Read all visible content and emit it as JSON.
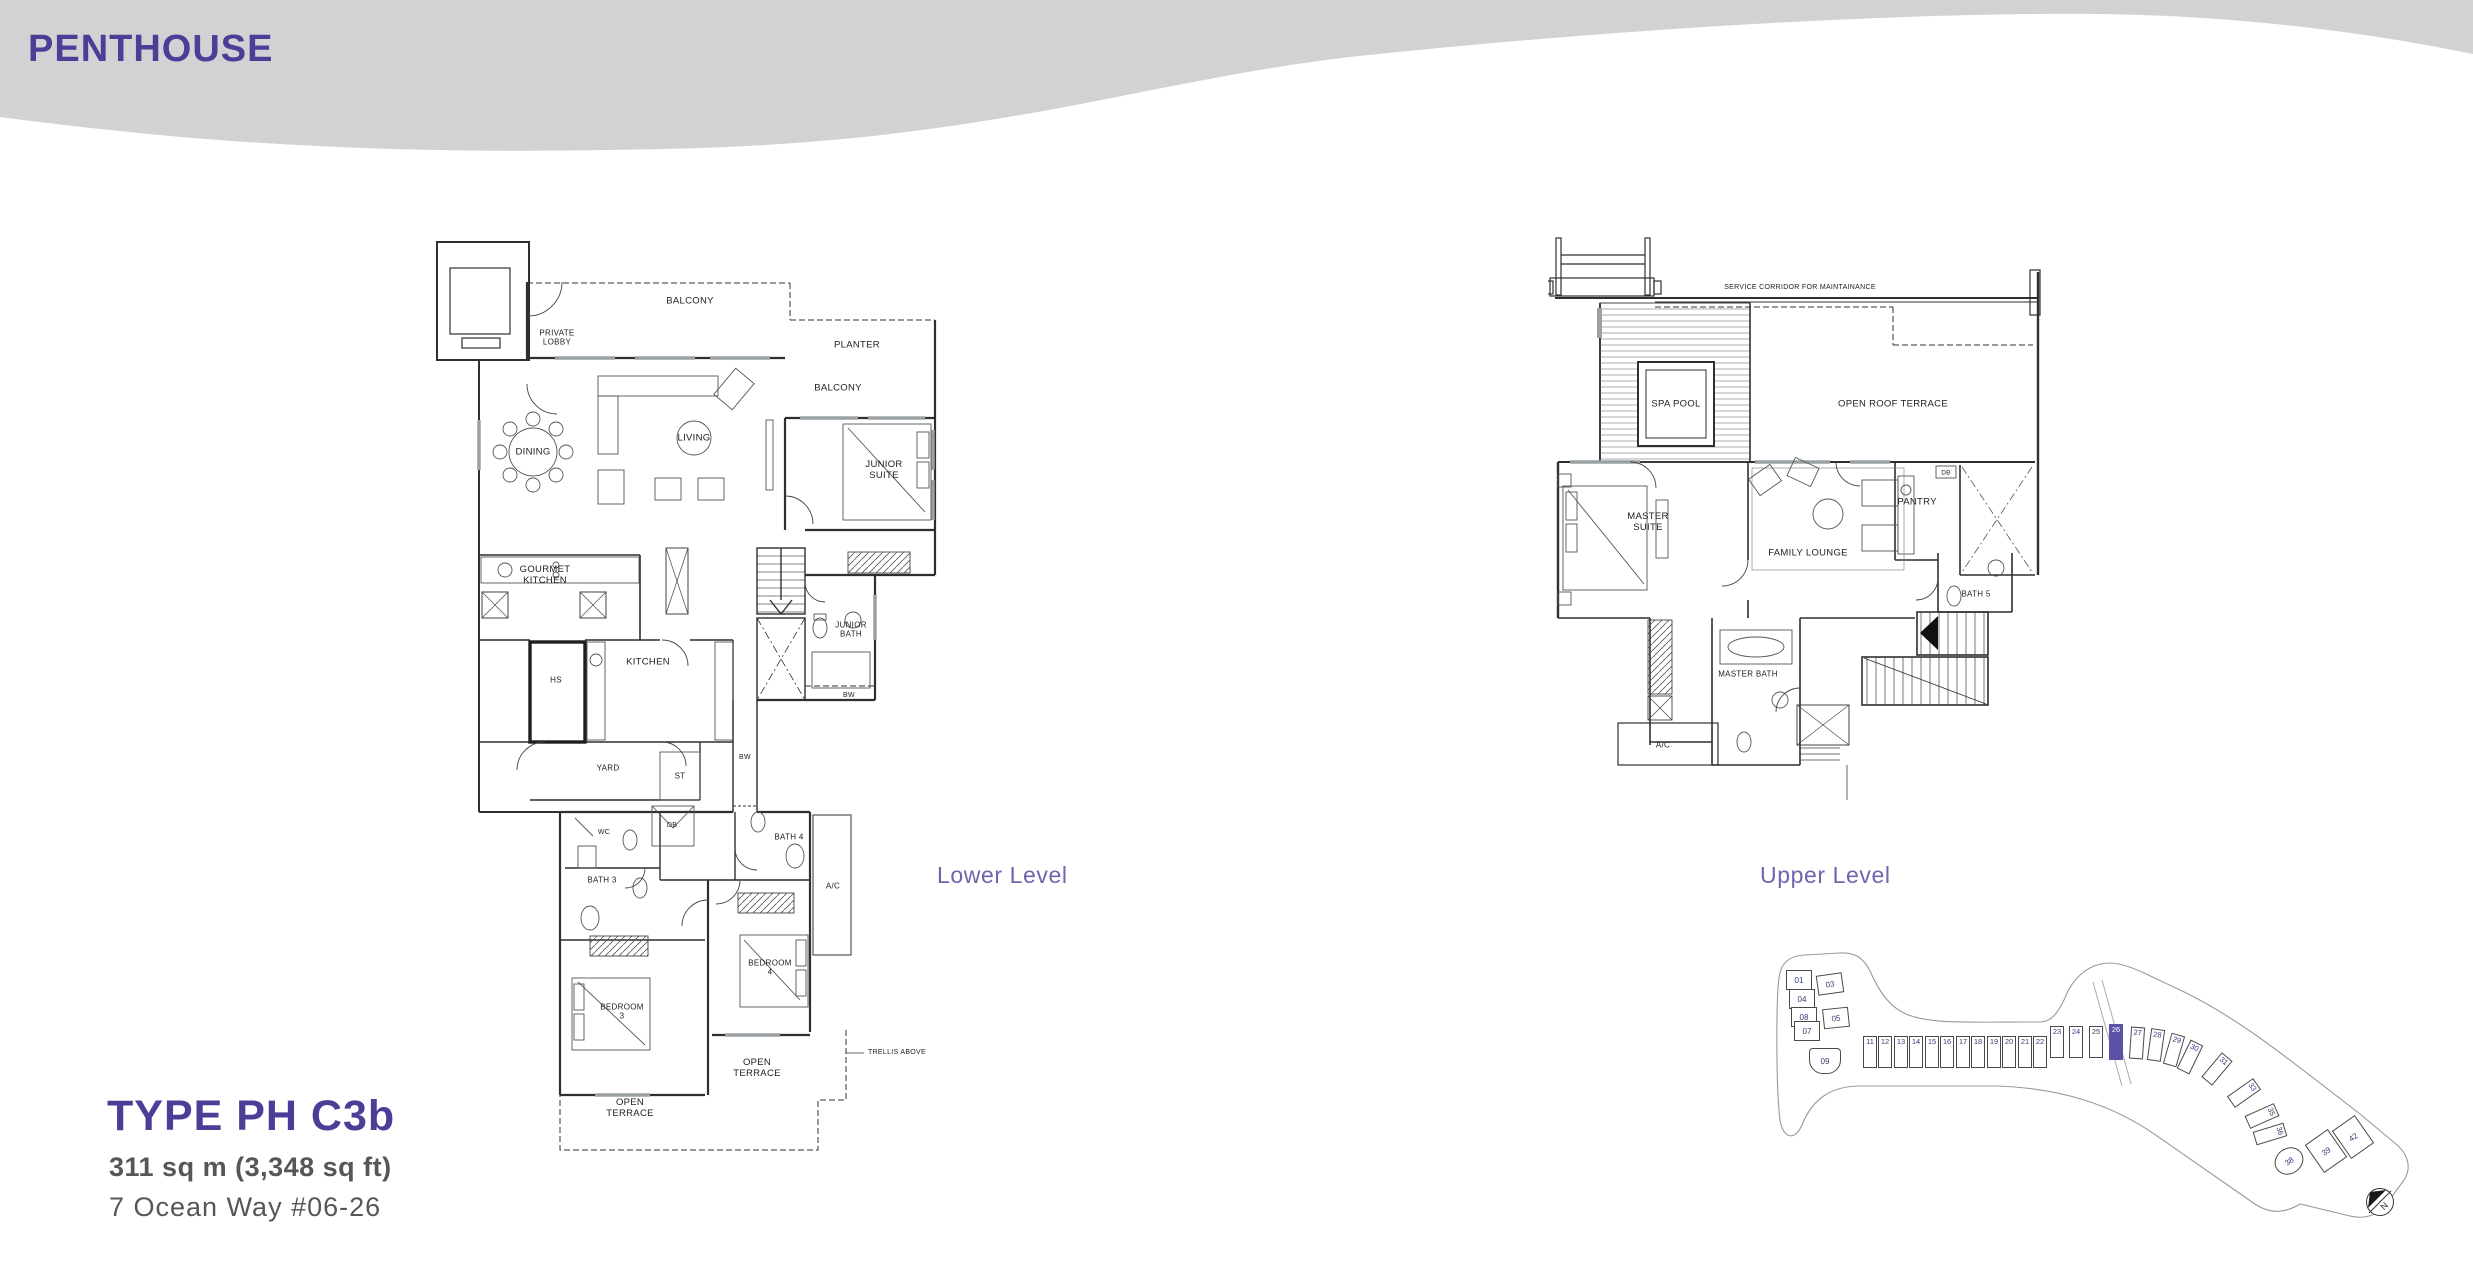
{
  "page": {
    "title": "PENTHOUSE"
  },
  "type_info": {
    "type_label": "TYPE PH C3b",
    "area": "311 sq m (3,348 sq ft)",
    "address": "7 Ocean Way  #06-26"
  },
  "lower_level": {
    "caption": "Lower Level",
    "labels": {
      "private_lobby": "PRIVATE\nLOBBY",
      "balcony_top": "BALCONY",
      "planter": "PLANTER",
      "balcony_right": "BALCONY",
      "dining": "DINING",
      "living": "LIVING",
      "junior_suite": "JUNIOR\nSUITE",
      "gourmet_kitchen": "GOURMET\nKITCHEN",
      "hs": "HS",
      "kitchen": "KITCHEN",
      "junior_bath": "JUNIOR\nBATH",
      "bw_bay": "BW",
      "bw_corridor": "BW",
      "yard": "YARD",
      "st": "ST",
      "db": "DB",
      "wc": "WC",
      "bath3": "BATH 3",
      "bath4": "BATH 4",
      "ac": "A/C",
      "bedroom3": "BEDROOM\n3",
      "bedroom4": "BEDROOM\n4",
      "open_terrace_right": "OPEN\nTERRACE",
      "open_terrace_left": "OPEN\nTERRACE",
      "trellis": "TRELLIS ABOVE"
    }
  },
  "upper_level": {
    "caption": "Upper Level",
    "labels": {
      "service_corridor": "SERVICE CORRIDOR FOR MAINTAINANCE",
      "spa_pool": "SPA POOL",
      "open_roof_terrace": "OPEN ROOF TERRACE",
      "master_suite": "MASTER\nSUITE",
      "family_lounge": "FAMILY LOUNGE",
      "pantry": "PANTRY",
      "db": "DB",
      "bath5": "BATH 5",
      "master_bath": "MASTER BATH",
      "ac": "A/C"
    }
  },
  "site_plan": {
    "highlighted_unit": "26",
    "north_label": "N",
    "units": [
      "01",
      "03",
      "04",
      "08",
      "05",
      "07",
      "09",
      "11",
      "12",
      "13",
      "14",
      "15",
      "16",
      "17",
      "18",
      "19",
      "20",
      "21",
      "22",
      "23",
      "24",
      "25",
      "26",
      "27",
      "28",
      "29",
      "30",
      "31",
      "33",
      "35",
      "36",
      "38",
      "39",
      "42"
    ]
  },
  "colors": {
    "accent_purple": "#4a3e97",
    "caption_purple": "#7064ae",
    "band_gray": "#d2d2d4",
    "text_gray": "#56565a",
    "highlight_unit": "#5b53a6"
  }
}
